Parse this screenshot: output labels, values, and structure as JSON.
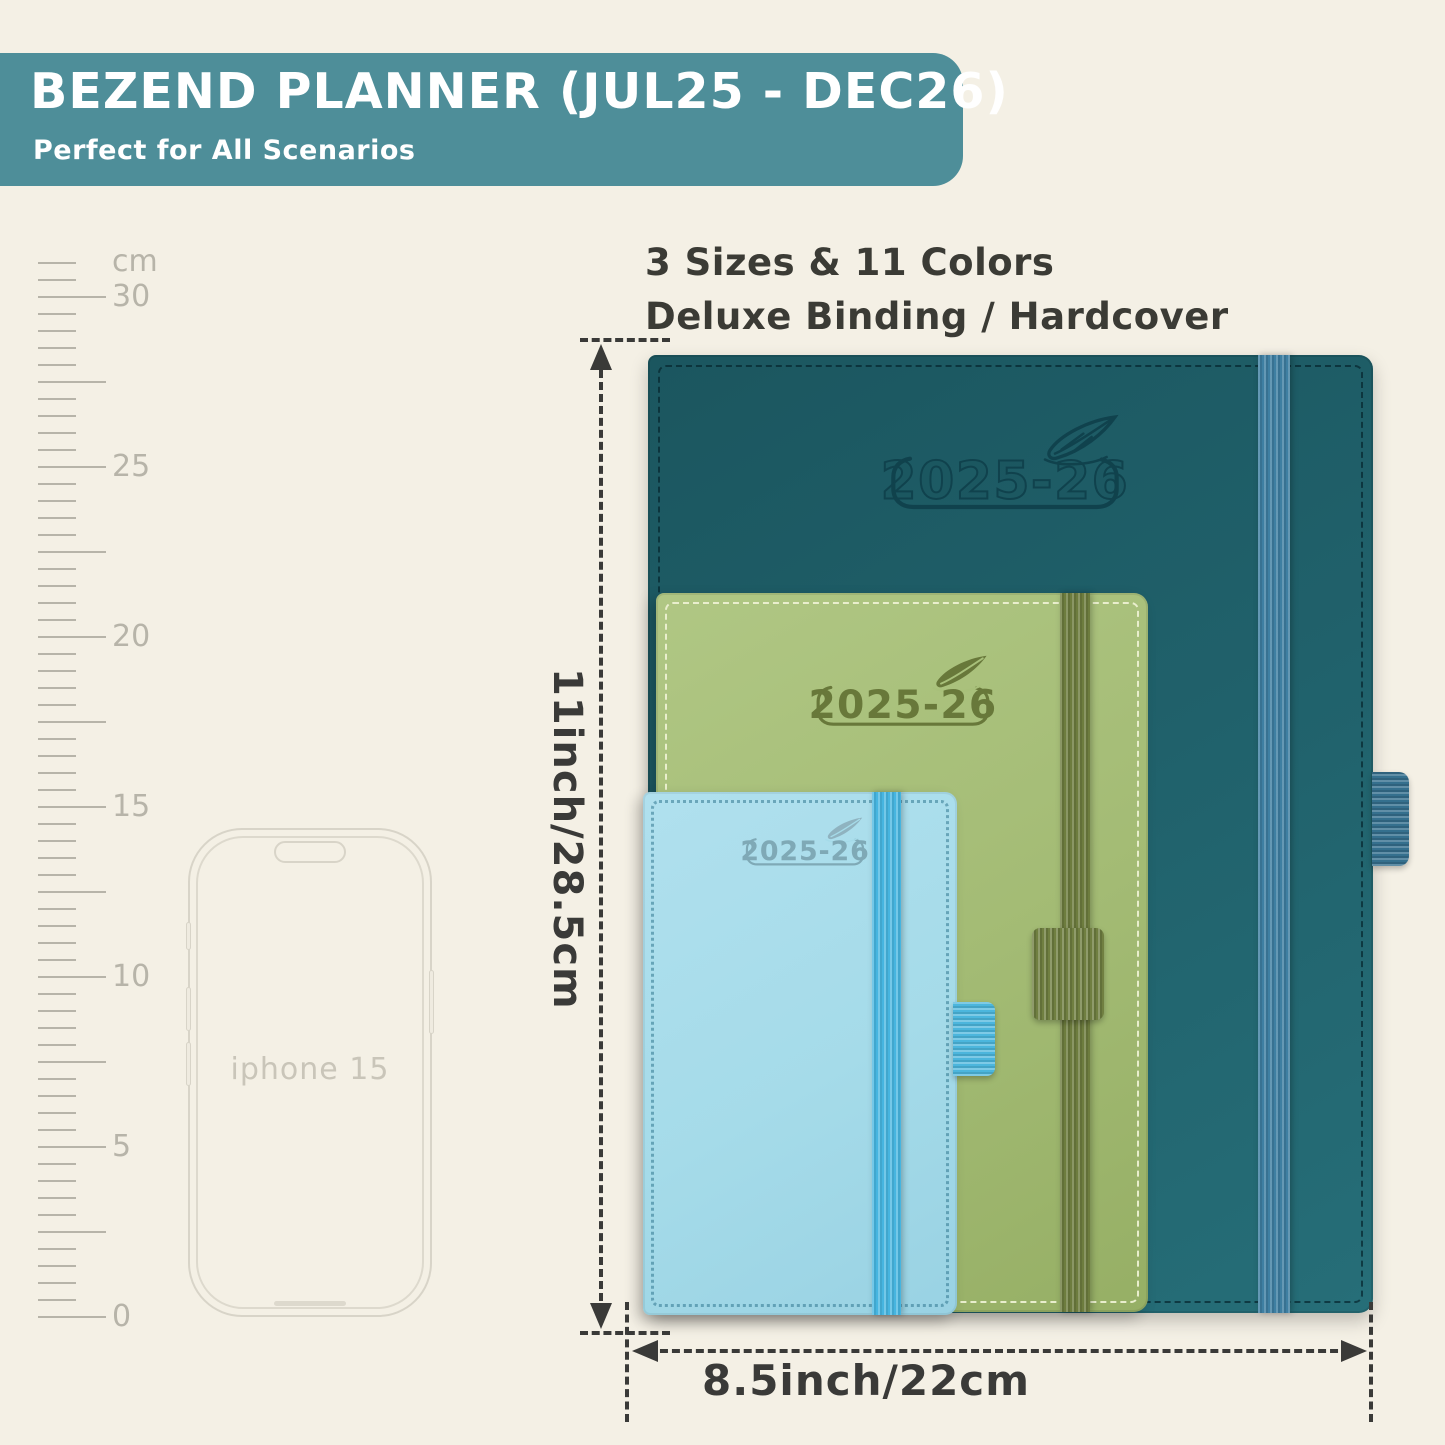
{
  "banner": {
    "title": "BEZEND PLANNER (JUL25 - DEC26)",
    "subtitle": "Perfect for All Scenarios",
    "bg_color": "#4E8E99"
  },
  "headline": {
    "line1": "3 Sizes & 11 Colors",
    "line2": "Deluxe Binding / Hardcover"
  },
  "ruler": {
    "unit_label": "cm",
    "labels": [
      "30",
      "25",
      "20",
      "15",
      "10",
      "5",
      "0"
    ]
  },
  "phone": {
    "label": "iphone 15"
  },
  "planners": [
    {
      "name": "large",
      "year_label": "2025-26",
      "cover_color": "#20616B",
      "band_color": "#3E7FA2"
    },
    {
      "name": "medium",
      "year_label": "2025-26",
      "cover_color": "#A3BB74",
      "band_color": "#6D7C3E"
    },
    {
      "name": "small",
      "year_label": "2025-26",
      "cover_color": "#A5DBE9",
      "band_color": "#46B5E0"
    }
  ],
  "dimensions": {
    "height_label": "11inch/28.5cm",
    "width_label": "8.5inch/22cm"
  },
  "icons": [
    "feather-icon",
    "arrow-up-icon",
    "arrow-down-icon",
    "arrow-left-icon",
    "arrow-right-icon"
  ],
  "colors": {
    "background": "#F4F0E5",
    "annotation": "#3A3A38",
    "ruler_gray": "#B7B4A9"
  }
}
